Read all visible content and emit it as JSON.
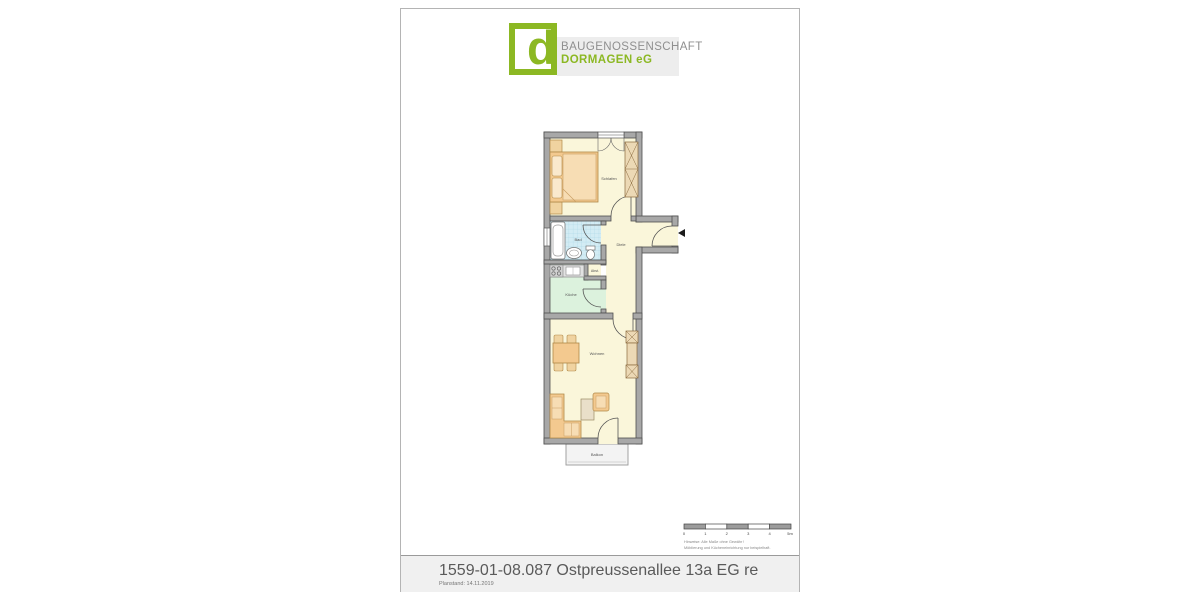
{
  "page": {
    "background": "#ffffff",
    "border_color": "#b4b4b4"
  },
  "logo": {
    "letter": "d",
    "line1": "BAUGENOSSENSCHAFT",
    "line2": "DORMAGEN eG",
    "green": "#8cb823",
    "gray": "#8f8f8f"
  },
  "floorplan": {
    "rooms": [
      {
        "id": "schlafen",
        "label": "Schlafen"
      },
      {
        "id": "bad",
        "label": "Bad"
      },
      {
        "id": "diele",
        "label": "Diele"
      },
      {
        "id": "abst",
        "label": "Abst."
      },
      {
        "id": "kueche",
        "label": "Küche"
      },
      {
        "id": "wohnen",
        "label": "Wohnen"
      },
      {
        "id": "balkon",
        "label": "Balkon"
      }
    ],
    "colors": {
      "floor_yellow": "#faf6da",
      "floor_bath_blue": "#d3ecf4",
      "floor_kitchen_green": "#dcf2dd",
      "wall_gray": "#a8a8a8",
      "furniture_tan": "#f3c98f"
    }
  },
  "scalebar": {
    "ticks": [
      "0",
      "1",
      "2",
      "3",
      "4",
      "5m"
    ],
    "note_line1": "Hinweise:  Alle Maße ohne Gewähr !",
    "note_line2": "Möblierung und Kücheneinrichtung nur beispielhaft."
  },
  "titleblock": {
    "title": "1559-01-08.087 Ostpreussenallee 13a EG re",
    "planstand": "Planstand: 14.11.2019"
  }
}
